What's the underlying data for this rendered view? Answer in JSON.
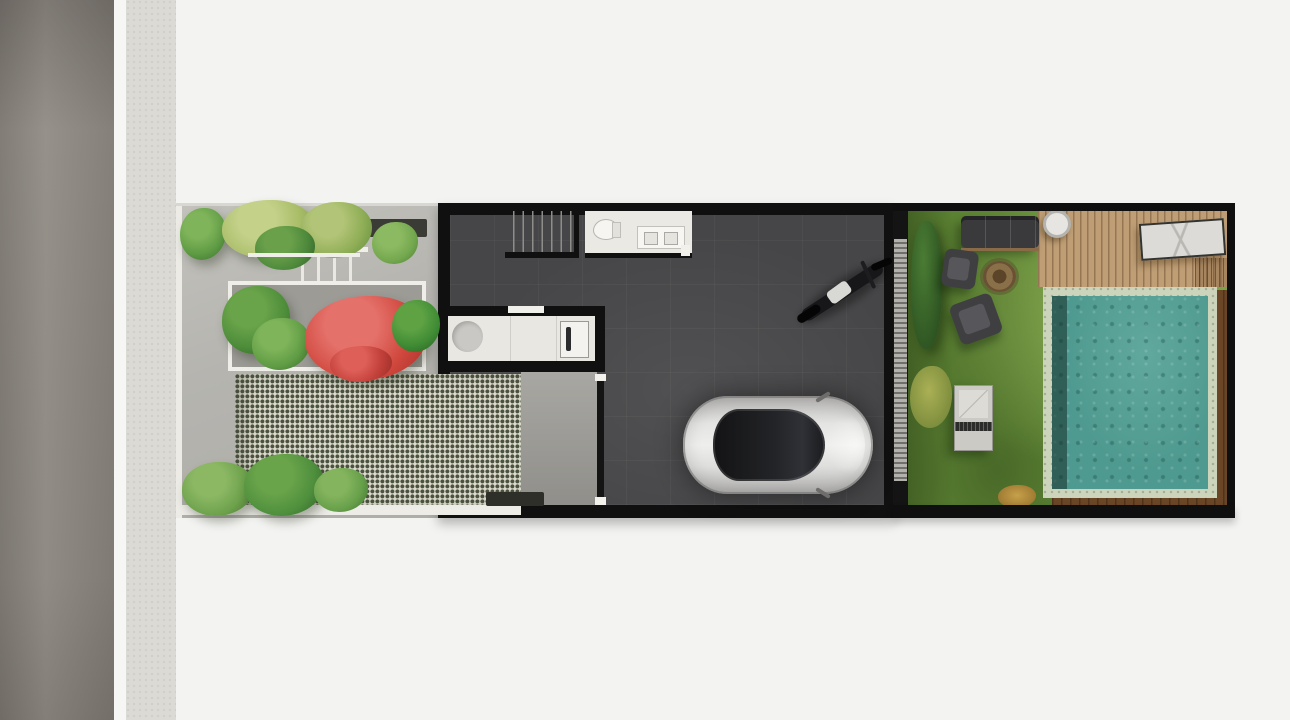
{
  "meta": {
    "title": "Townhouse ground-floor site plan — top-down 3D render",
    "view": "plan view, no text labels visible",
    "orientation": "street on the left, rear garden with pool on the right"
  },
  "palette": {
    "background": "#f3f3f1",
    "road": "#8c8780",
    "curb_line": "#f6f6f4",
    "sidewalk": "#dbdad4",
    "garden_paving": "#b5b4af",
    "grass_block_paver_light": "#dcdbce",
    "grass_block_paver_dark": "#4b5340",
    "house_wall": "#101010",
    "house_floor": "#464648",
    "wet_rooms": "#ebe9e4",
    "car_body": "#e4e4e2",
    "lawn": "#6f9a3e",
    "deck_wood": "#bf9e75",
    "pool_coping": "#ccd5bc",
    "pool_water": "#4f9a90",
    "pool_surround_wood": "#6a4526",
    "bougainvillea_red": "#d0473d",
    "foliage_lime": "#a9bd68",
    "foliage_green": "#5f9c44",
    "foliage_dark": "#39672e"
  },
  "scene": {
    "street": {
      "label": "Asphalt road with white edge line and concrete sidewalk"
    },
    "front_yard": {
      "label": "Front courtyard garden",
      "paving": {
        "label": "Grey concrete paving"
      },
      "steps": {
        "label": "Entry steps"
      },
      "planter_box": {
        "label": "Planter with red bougainvillea and palms"
      },
      "grass_pavers": {
        "label": "Green grass-block paver parking strip"
      },
      "driveway": {
        "label": "Concrete driveway strip at garage gate"
      },
      "gate": {
        "label": "Garage entry gate"
      },
      "trees_top": {
        "label": "Canopy trees along north boundary"
      },
      "palms_bottom": {
        "label": "Palm shrubs along south boundary"
      }
    },
    "house": {
      "label": "Ground floor — open garage / carport hall",
      "stairs": {
        "label": "Staircase to upper floor"
      },
      "bathroom": {
        "label": "Bathroom with toilet and vanity"
      },
      "kitchen": {
        "label": "Kitchenette counter with round sink and cooktop"
      },
      "car": {
        "label": "Silver car parked facing the rear garden"
      },
      "motorcycle": {
        "label": "Motorcycle parked diagonally"
      },
      "louver_wall": {
        "label": "Slatted louver partition to the rear garden"
      }
    },
    "backyard": {
      "label": "Rear garden",
      "lawn": {
        "label": "Lawn"
      },
      "deck": {
        "label": "Timber deck"
      },
      "pool": {
        "label": "Swimming pool with stone coping and mosaic water"
      },
      "sofa": {
        "label": "Outdoor sofa"
      },
      "armchair_1": {
        "label": "Lounge chair"
      },
      "armchair_2": {
        "label": "Lounge chair (angled)"
      },
      "fire_pit": {
        "label": "Round fire pit"
      },
      "side_table": {
        "label": "Garden bench / table"
      },
      "round_table": {
        "label": "Round deck table"
      },
      "sun_lounger": {
        "label": "Sun lounger on deck"
      },
      "hedge": {
        "label": "Hedge along louver wall"
      },
      "bushes": {
        "label": "Yellow and orange accent shrubs"
      }
    }
  }
}
